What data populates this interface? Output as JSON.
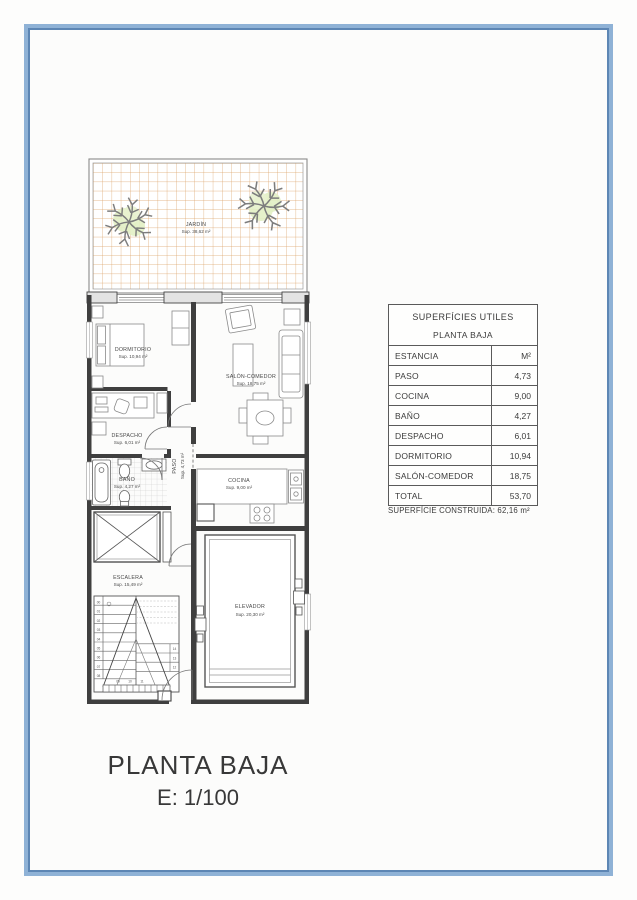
{
  "page": {
    "title_line1": "PLANTA BAJA",
    "title_line2": "E: 1/100"
  },
  "colors": {
    "frame_blue": "#8fb2d6",
    "frame_blue_dark": "#5d86b4",
    "garden_grid_orange": "#dca268",
    "tree_green": "#e2efc4",
    "wall_dark": "#3f3f3f"
  },
  "plan": {
    "jardin": {
      "name": "JARDÍN",
      "sup": "Sup. 38,62 m²"
    },
    "dormitorio": {
      "name": "DORMITORIO",
      "sup": "Sup. 10,94 m²"
    },
    "salon": {
      "name": "SALÓN-COMEDOR",
      "sup": "Sup. 18,75 m²"
    },
    "despacho": {
      "name": "DESPACHO",
      "sup": "Sup. 6,01 m²"
    },
    "bano": {
      "name": "BAÑO",
      "sup": "Sup. 4,27 m²"
    },
    "paso": {
      "name": "PASO",
      "sup": "Sup. 4,73 m²"
    },
    "cocina": {
      "name": "COCINA",
      "sup": "Sup. 9,00 m²"
    },
    "escalera": {
      "name": "ESCALERA",
      "sup": "Sup. 15,49 m²",
      "steps": [
        "00",
        "01",
        "02",
        "03",
        "04",
        "05",
        "06",
        "07",
        "08",
        "09",
        "10",
        "11",
        "12",
        "13",
        "14"
      ]
    },
    "elevador": {
      "name": "ELEVADOR",
      "sup": "Sup. 20,30 m²"
    }
  },
  "table": {
    "title": "SUPERFÍCIES UTILES",
    "subtitle": "PLANTA BAJA",
    "col_label": "ESTANCIA",
    "col_value": "M²",
    "rows": [
      {
        "label": "PASO",
        "value": "4,73"
      },
      {
        "label": "COCINA",
        "value": "9,00"
      },
      {
        "label": "BAÑO",
        "value": "4,27"
      },
      {
        "label": "DESPACHO",
        "value": "6,01"
      },
      {
        "label": "DORMITORIO",
        "value": "10,94"
      },
      {
        "label": "SALÓN-COMEDOR",
        "value": "18,75"
      },
      {
        "label": "TOTAL",
        "value": "53,70"
      }
    ],
    "footer": "SUPERFÍCIE CONSTRUIDA: 62,16 m²"
  }
}
